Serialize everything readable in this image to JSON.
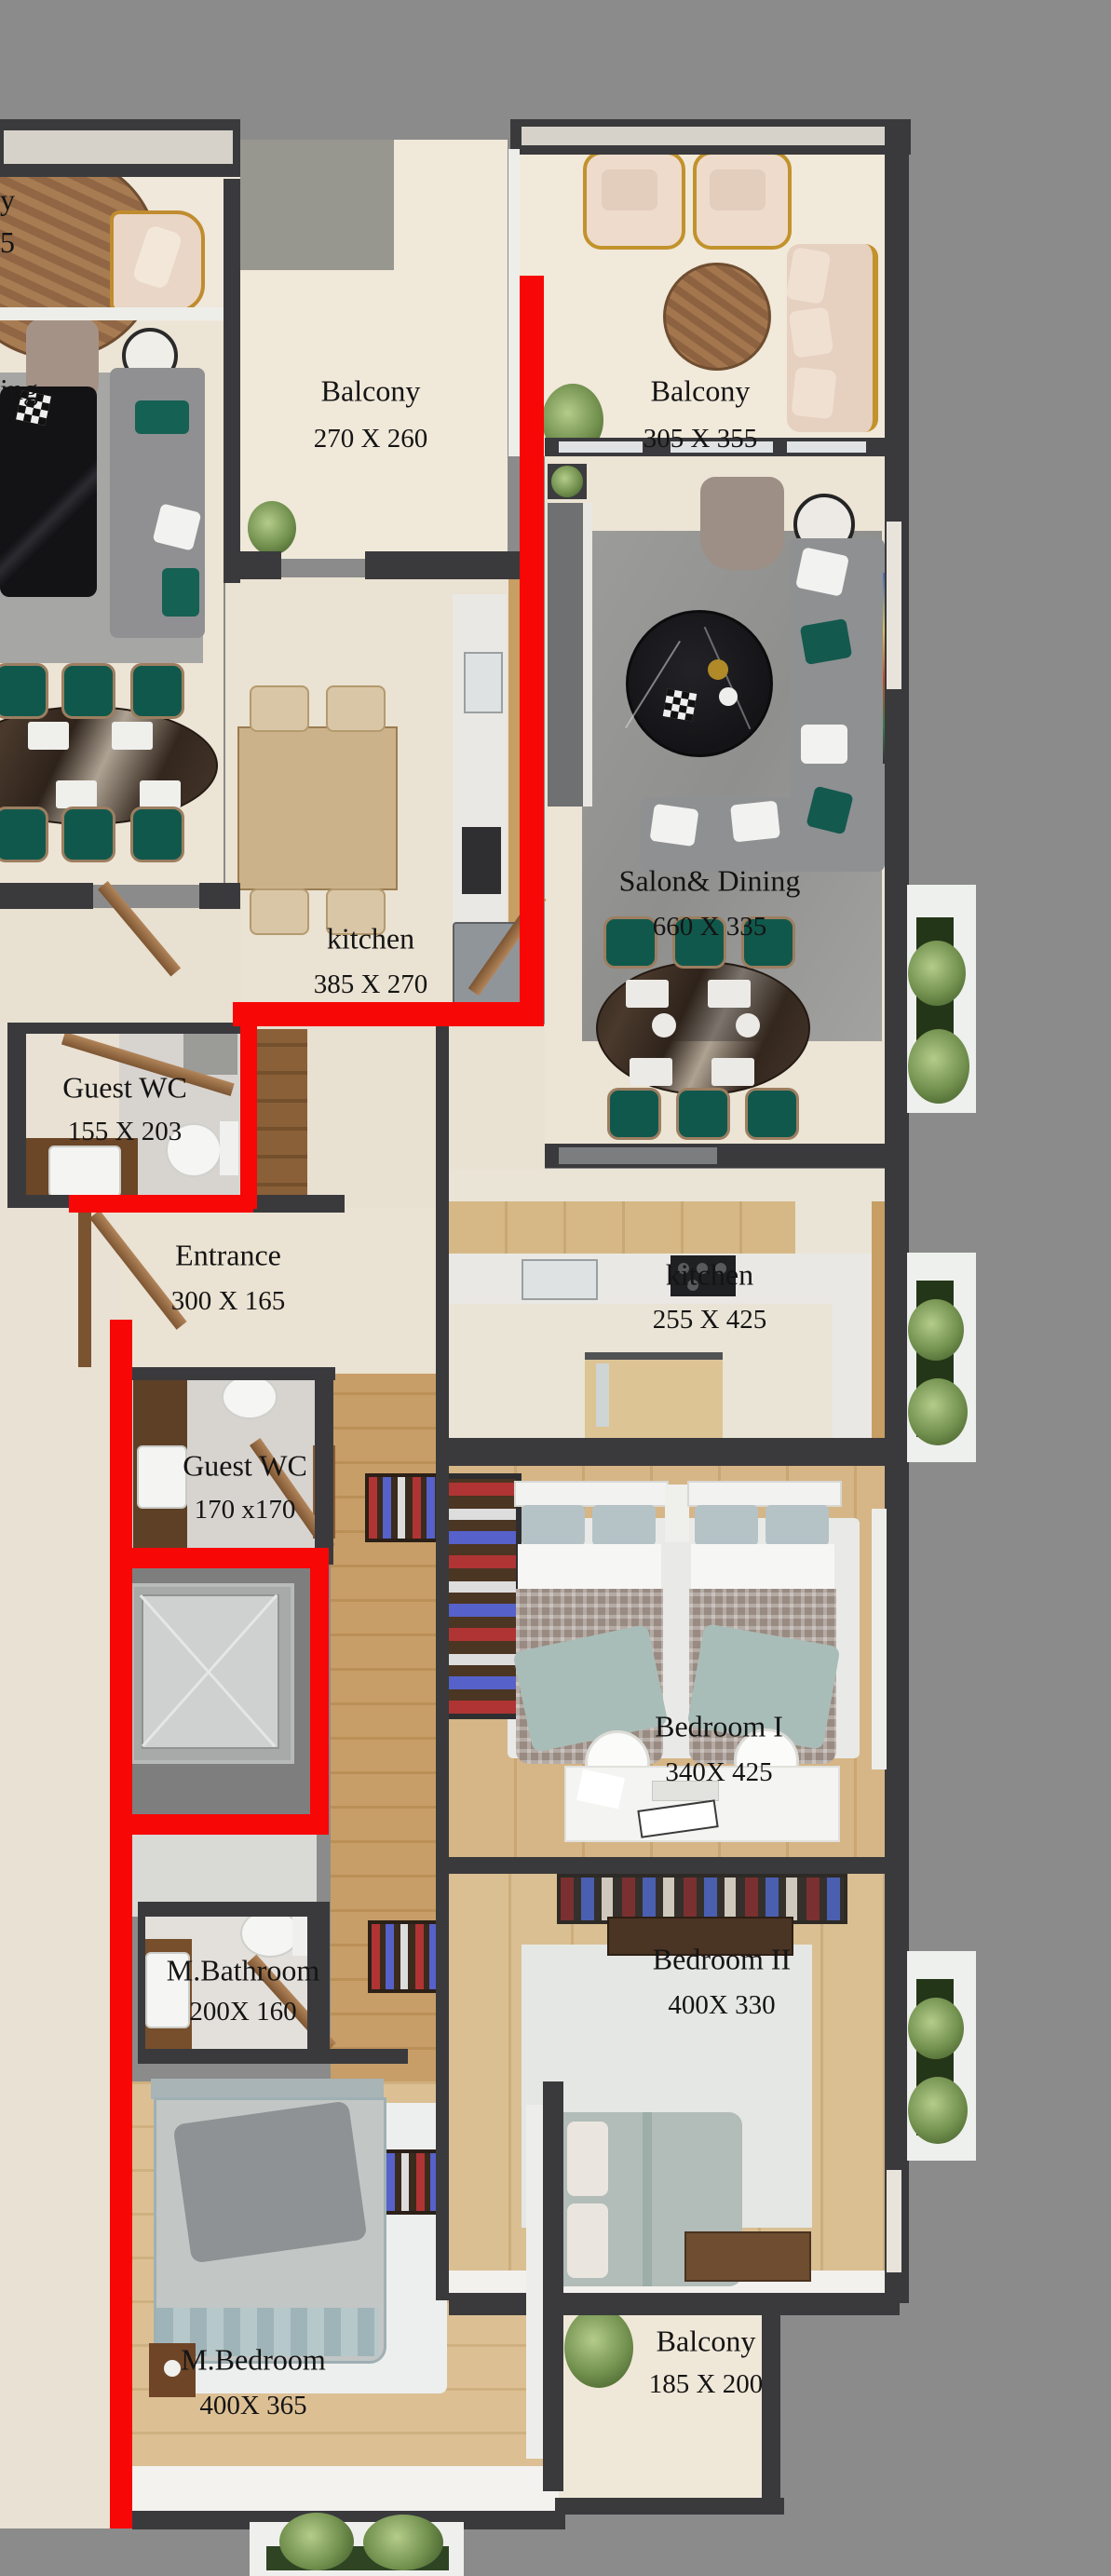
{
  "palette": {
    "background": "#8b8b8b",
    "wall": "#3a3a3d",
    "unit_boundary_red": "#f80707",
    "floor_beige": "#ece4d5",
    "floor_wood": "#d3b184",
    "label_color": "#141414"
  },
  "rooms": [
    {
      "id": "balcony-left",
      "name": "Balcony",
      "dims": "270 X 260"
    },
    {
      "id": "balcony-right",
      "name": "Balcony",
      "dims": "305 X 355"
    },
    {
      "id": "salon-dining",
      "name": "Salon& Dining",
      "dims": "660 X 335"
    },
    {
      "id": "kitchen-left",
      "name": "kitchen",
      "dims": "385 X 270"
    },
    {
      "id": "guest-wc-1",
      "name": "Guest WC",
      "dims": "155 X 203"
    },
    {
      "id": "entrance",
      "name": "Entrance",
      "dims": "300 X 165"
    },
    {
      "id": "kitchen-right",
      "name": "kitchen",
      "dims": "255 X 425"
    },
    {
      "id": "guest-wc-2",
      "name": "Guest WC",
      "dims": "170 x170"
    },
    {
      "id": "bedroom-1",
      "name": "Bedroom I",
      "dims": "340X 425"
    },
    {
      "id": "bedroom-2",
      "name": "Bedroom II",
      "dims": "400X 330"
    },
    {
      "id": "m-bathroom",
      "name": "M.Bathroom",
      "dims": "200X 160"
    },
    {
      "id": "m-bedroom",
      "name": "M.Bedroom",
      "dims": "400X 365"
    },
    {
      "id": "balcony-bottom",
      "name": "Balcony",
      "dims": "185 X 200"
    }
  ],
  "cut_labels": {
    "top_line1": "y",
    "top_line2": "5",
    "left": "ing"
  }
}
